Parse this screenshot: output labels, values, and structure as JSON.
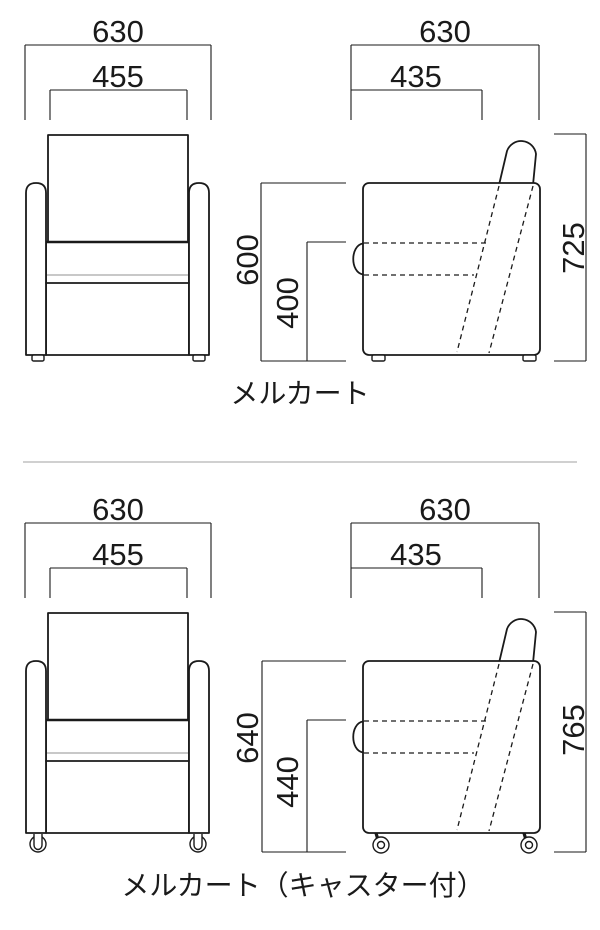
{
  "colors": {
    "bg": "#ffffff",
    "line": "#1a1a1a",
    "light": "#b5b5b5",
    "divider": "#b3b3b3"
  },
  "panels": [
    {
      "label": "メルカート",
      "dims": {
        "overall_width": "630",
        "inner_width": "455",
        "overall_depth": "630",
        "seat_depth": "435",
        "arm_height": "600",
        "seat_height": "400",
        "total_height": "725"
      }
    },
    {
      "label": "メルカート（キャスター付）",
      "dims": {
        "overall_width": "630",
        "inner_width": "455",
        "overall_depth": "630",
        "seat_depth": "435",
        "arm_height": "640",
        "seat_height": "440",
        "total_height": "765"
      }
    }
  ]
}
